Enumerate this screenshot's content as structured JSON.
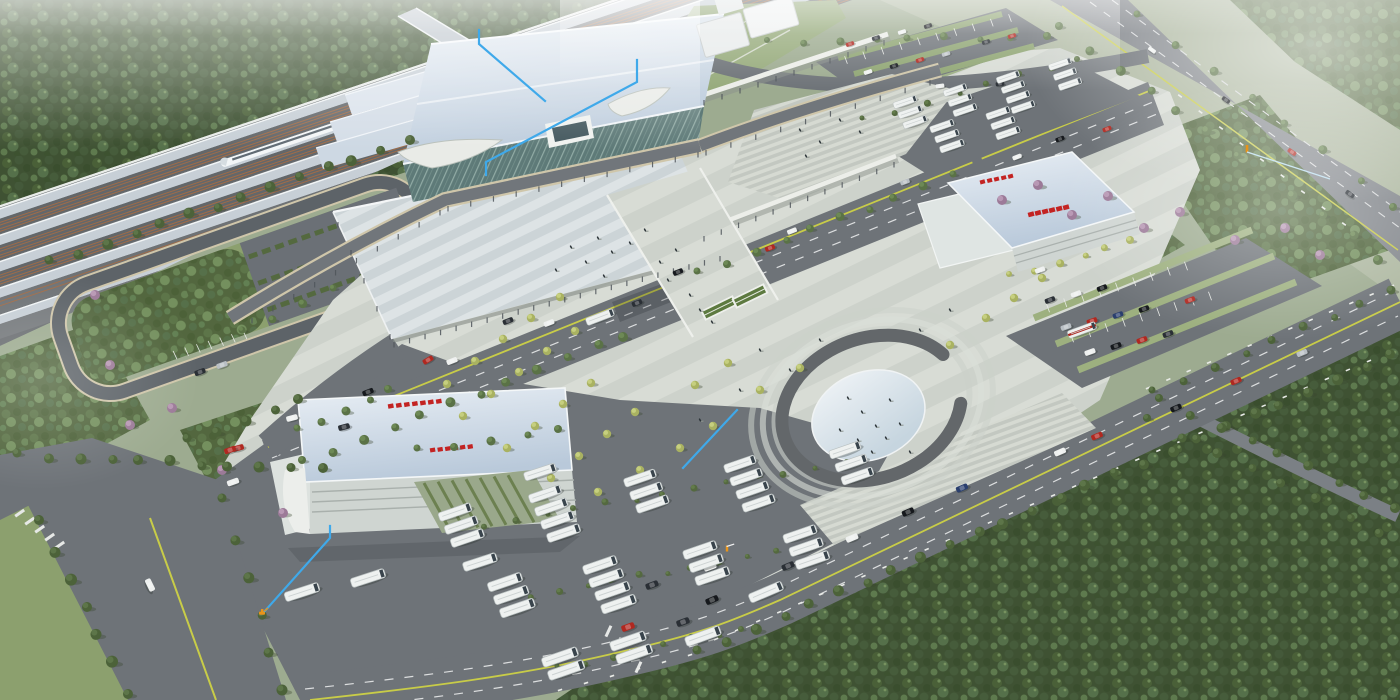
{
  "scene": {
    "type": "aerial-architectural-rendering",
    "subject": "railway-station-complex-masterplan",
    "palette": {
      "base": "#9dab90",
      "fieldLight": "#aeb8a1",
      "forest": "#3f5233",
      "grove": "#53673f",
      "grass": "#8ca06e",
      "lawn": "#97ab7c",
      "road": "#6e7378",
      "roadDark": "#5d6368",
      "hwy": "#83878c",
      "curb": "#cfc6aa",
      "lane": "#dcdedf",
      "yellow": "#c8cc48",
      "plaza": "#d3d7d0",
      "canopy": "#ccd4d7",
      "roof": "#c6d3e2",
      "annex": "#cdd8e3",
      "glass": "#5e7a78",
      "white": "#eef0ef",
      "silver": "#b9bfc4",
      "steel": "#c7cfd6",
      "trackbed": "#6a6e71",
      "ballast": "#a06c48",
      "hedge": "#54693f",
      "treeLight": "#a9b261",
      "treeDark": "#4e6540",
      "blossom": "#9c7a98",
      "red": "#b02820",
      "black": "#16191d",
      "darkcar": "#2a2f35",
      "bluecar": "#2a3f6e",
      "signRed": "#c32322",
      "blue": "#3fa9ea",
      "orange": "#e8941a",
      "oval": "#e6edf2",
      "ovalRing": "#63676a",
      "step": "#ccd1ca"
    },
    "annotation_lines": [
      {
        "points": [
          [
            479,
            30
          ],
          [
            479,
            44
          ],
          [
            545,
            101
          ]
        ]
      },
      {
        "points": [
          [
            486,
            175
          ],
          [
            486,
            162
          ],
          [
            637,
            82
          ],
          [
            637,
            60
          ]
        ]
      },
      {
        "points": [
          [
            737,
            410
          ],
          [
            683,
            468
          ]
        ]
      },
      {
        "points": [
          [
            330,
            526
          ],
          [
            330,
            538
          ],
          [
            264,
            612
          ]
        ]
      }
    ],
    "markers": [
      {
        "kind": "excavator",
        "x": 262,
        "y": 613
      },
      {
        "kind": "gate",
        "x": 727,
        "y": 551
      },
      {
        "kind": "crane",
        "x": 1247,
        "y": 152,
        "line_to": [
          1330,
          179
        ]
      }
    ],
    "vehicles": [
      [
        368,
        392,
        -21,
        "black"
      ],
      [
        452,
        361,
        -21,
        "white"
      ],
      [
        508,
        321,
        -21,
        "darkcar"
      ],
      [
        549,
        323,
        -21,
        "white"
      ],
      [
        637,
        303,
        -21,
        "darkcar"
      ],
      [
        678,
        272,
        -21,
        "black"
      ],
      [
        770,
        248,
        -21,
        "red"
      ],
      [
        792,
        231,
        -21,
        "white"
      ],
      [
        905,
        182,
        -21,
        "silver"
      ],
      [
        1017,
        157,
        -21,
        "white"
      ],
      [
        1060,
        139,
        -21,
        "black"
      ],
      [
        1107,
        129,
        -21,
        "red"
      ],
      [
        600,
        317,
        -21,
        "white",
        "bus"
      ],
      [
        428,
        360,
        -30,
        "red"
      ],
      [
        238,
        448,
        -15,
        "red"
      ],
      [
        292,
        418,
        -15,
        "white"
      ],
      [
        344,
        427,
        -15,
        "darkcar"
      ],
      [
        712,
        600,
        -23,
        "black"
      ],
      [
        788,
        566,
        -23,
        "darkcar"
      ],
      [
        852,
        538,
        -23,
        "white"
      ],
      [
        908,
        512,
        -23,
        "black"
      ],
      [
        962,
        488,
        -23,
        "bluecar"
      ],
      [
        1060,
        452,
        -23,
        "white"
      ],
      [
        1097,
        436,
        -23,
        "red"
      ],
      [
        1176,
        408,
        -23,
        "black"
      ],
      [
        1236,
        381,
        -23,
        "red"
      ],
      [
        1302,
        353,
        -23,
        "silver"
      ],
      [
        766,
        592,
        -23,
        "white",
        "bus"
      ],
      [
        628,
        627,
        -20,
        "red"
      ],
      [
        683,
        622,
        -20,
        "darkcar"
      ],
      [
        703,
        636,
        -20,
        "white",
        "bus"
      ],
      [
        1152,
        50,
        35,
        "white"
      ],
      [
        1226,
        100,
        35,
        "black"
      ],
      [
        1292,
        152,
        35,
        "red"
      ],
      [
        1350,
        194,
        35,
        "darkcar"
      ],
      [
        150,
        585,
        64,
        "white"
      ],
      [
        710,
        567,
        -20,
        "white"
      ],
      [
        652,
        585,
        -20,
        "darkcar"
      ],
      [
        850,
        44,
        -18,
        "red"
      ],
      [
        876,
        38,
        -18,
        "darkcar"
      ],
      [
        902,
        32,
        -18,
        "white"
      ],
      [
        928,
        26,
        -18,
        "black"
      ],
      [
        868,
        72,
        -18,
        "white"
      ],
      [
        894,
        66,
        -18,
        "black"
      ],
      [
        920,
        60,
        -18,
        "red"
      ],
      [
        946,
        54,
        -18,
        "silver"
      ],
      [
        986,
        42,
        -18,
        "darkcar"
      ],
      [
        1012,
        36,
        -18,
        "red"
      ],
      [
        1050,
        300,
        -20,
        "darkcar"
      ],
      [
        1076,
        294,
        -20,
        "white"
      ],
      [
        1102,
        288,
        -20,
        "black"
      ],
      [
        1066,
        327,
        -20,
        "silver"
      ],
      [
        1092,
        321,
        -20,
        "red"
      ],
      [
        1118,
        315,
        -20,
        "bluecar"
      ],
      [
        1144,
        309,
        -20,
        "black"
      ],
      [
        1090,
        352,
        -20,
        "white"
      ],
      [
        1116,
        346,
        -20,
        "black"
      ],
      [
        1142,
        340,
        -20,
        "red"
      ],
      [
        1168,
        334,
        -20,
        "darkcar"
      ],
      [
        1040,
        270,
        -20,
        "white"
      ],
      [
        1190,
        300,
        -20,
        "red"
      ],
      [
        200,
        372,
        -20,
        "darkcar"
      ],
      [
        222,
        365,
        -20,
        "silver"
      ],
      [
        230,
        450,
        -20,
        "red"
      ],
      [
        233,
        482,
        -20,
        "white"
      ],
      [
        940,
        86,
        -8,
        "white"
      ],
      [
        1000,
        84,
        -5,
        "darkcar"
      ]
    ],
    "bus_clusters": [
      [
        455,
        512,
        3
      ],
      [
        545,
        494,
        4
      ],
      [
        640,
        478,
        3
      ],
      [
        740,
        464,
        4
      ],
      [
        845,
        450,
        3
      ],
      [
        505,
        582,
        3
      ],
      [
        600,
        565,
        4
      ],
      [
        700,
        550,
        3
      ],
      [
        800,
        534,
        3
      ],
      [
        628,
        641,
        2
      ],
      [
        560,
        657,
        2
      ]
    ],
    "north_bus_clusters": [
      [
        905,
        102,
        3
      ],
      [
        955,
        90,
        3
      ],
      [
        1008,
        77,
        4
      ],
      [
        1060,
        64,
        3
      ],
      [
        942,
        126,
        3
      ],
      [
        998,
        113,
        3
      ]
    ],
    "single_buses": [
      [
        302,
        592,
        -18
      ],
      [
        368,
        578,
        -18
      ],
      [
        480,
        562,
        -18
      ],
      [
        540,
        472,
        -18
      ],
      [
        1082,
        330,
        -20,
        "red"
      ]
    ],
    "plaza_trees": [
      [
        447,
        384
      ],
      [
        475,
        361
      ],
      [
        503,
        339
      ],
      [
        531,
        318
      ],
      [
        560,
        297
      ],
      [
        463,
        416
      ],
      [
        491,
        394
      ],
      [
        519,
        372
      ],
      [
        547,
        351
      ],
      [
        575,
        331
      ],
      [
        507,
        448
      ],
      [
        535,
        426
      ],
      [
        563,
        404
      ],
      [
        591,
        383
      ],
      [
        551,
        478
      ],
      [
        579,
        456
      ],
      [
        607,
        434
      ],
      [
        635,
        412
      ],
      [
        598,
        492
      ],
      [
        640,
        470
      ],
      [
        680,
        448
      ],
      [
        713,
        426
      ],
      [
        760,
        390
      ],
      [
        800,
        368
      ],
      [
        695,
        385
      ],
      [
        728,
        363
      ],
      [
        986,
        318
      ],
      [
        1014,
        298
      ],
      [
        1042,
        278
      ],
      [
        950,
        345
      ]
    ],
    "blossom_trees": [
      [
        110,
        365
      ],
      [
        130,
        425
      ],
      [
        172,
        408
      ],
      [
        283,
        513
      ],
      [
        222,
        470
      ],
      [
        95,
        295
      ],
      [
        1002,
        200
      ],
      [
        1038,
        185
      ],
      [
        1072,
        215
      ],
      [
        1108,
        196
      ],
      [
        1144,
        228
      ],
      [
        1180,
        212
      ],
      [
        1235,
        240
      ],
      [
        1285,
        228
      ],
      [
        1320,
        255
      ]
    ],
    "tree_lines": [
      {
        "a": [
          700,
          652
        ],
        "b": [
          1392,
          356
        ],
        "n": 26,
        "r": 5,
        "c": "f"
      },
      {
        "a": [
          1155,
          392
        ],
        "b": [
          1392,
          290
        ],
        "n": 9,
        "r": 4,
        "c": "f"
      },
      {
        "a": [
          1062,
          28
        ],
        "b": [
          1380,
          258
        ],
        "n": 12,
        "r": 4.5,
        "c": "g"
      },
      {
        "a": [
          1140,
          16
        ],
        "b": [
          1396,
          206
        ],
        "n": 8,
        "r": 4,
        "c": "g"
      },
      {
        "a": [
          1162,
          400
        ],
        "b": [
          1396,
          508
        ],
        "n": 9,
        "r": 4.5,
        "c": "f"
      },
      {
        "a": [
          1150,
          420
        ],
        "b": [
          1382,
          532
        ],
        "n": 8,
        "r": 4.5,
        "c": "f"
      },
      {
        "a": [
          300,
          430
        ],
        "b": [
          390,
          390
        ],
        "n": 5,
        "r": 4,
        "c": "g"
      },
      {
        "a": [
          305,
          462
        ],
        "b": [
          625,
          335
        ],
        "n": 12,
        "r": 4.5,
        "c": "g"
      },
      {
        "a": [
          700,
          273
        ],
        "b": [
          952,
          175
        ],
        "n": 10,
        "r": 4,
        "c": "g"
      },
      {
        "a": [
          42,
          522
        ],
        "b": [
          126,
          692
        ],
        "n": 7,
        "r": 5.5,
        "c": "f"
      },
      {
        "a": [
          225,
          500
        ],
        "b": [
          282,
          692
        ],
        "n": 6,
        "r": 5,
        "c": "f"
      },
      {
        "a": [
          52,
          262
        ],
        "b": [
          408,
          140
        ],
        "n": 14,
        "r": 5,
        "c": "f"
      },
      {
        "a": [
          20,
          455
        ],
        "b": [
          320,
          470
        ],
        "n": 11,
        "r": 5,
        "c": "f"
      },
      {
        "a": [
          190,
          440
        ],
        "b": [
          300,
          400
        ],
        "n": 5,
        "r": 5,
        "c": "f"
      },
      {
        "a": [
          455,
          530
        ],
        "b": [
          845,
          462
        ],
        "n": 14,
        "r": 3,
        "c": "h"
      },
      {
        "a": [
          505,
          600
        ],
        "b": [
          800,
          548
        ],
        "n": 12,
        "r": 3,
        "c": "h"
      },
      {
        "a": [
          560,
          668
        ],
        "b": [
          744,
          628
        ],
        "n": 8,
        "r": 3,
        "c": "h"
      },
      {
        "a": [
          865,
          120
        ],
        "b": [
          1080,
          58
        ],
        "n": 8,
        "r": 3,
        "c": "h"
      },
      {
        "a": [
          1012,
          276
        ],
        "b": [
          1130,
          242
        ],
        "n": 6,
        "r": 3.5,
        "c": "l"
      },
      {
        "a": [
          245,
          332
        ],
        "b": [
          330,
          288
        ],
        "n": 4,
        "r": 4,
        "c": "g"
      },
      {
        "a": [
          420,
          450
        ],
        "b": [
          560,
          430
        ],
        "n": 5,
        "r": 4,
        "c": "g"
      },
      {
        "a": [
          770,
          42
        ],
        "b": [
          1048,
          36
        ],
        "n": 9,
        "r": 3.5,
        "c": "g"
      }
    ],
    "curb_dash_lines": [
      {
        "a": [
          695,
          648
        ],
        "b": [
          1390,
          352
        ],
        "n": 34,
        "rot": -23
      },
      {
        "a": [
          1148,
          388
        ],
        "b": [
          1392,
          286
        ],
        "n": 13,
        "rot": -23
      },
      {
        "a": [
          1180,
          96
        ],
        "b": [
          1344,
          224
        ],
        "n": 9,
        "rot": 36
      },
      {
        "a": [
          560,
          690
        ],
        "b": [
          690,
          655
        ],
        "n": 6,
        "rot": -18
      },
      {
        "a": [
          175,
          355
        ],
        "b": [
          245,
          335
        ],
        "n": 7,
        "rot": 65,
        "l": 9,
        "w": 0.8
      },
      {
        "a": [
          846,
          60
        ],
        "b": [
          1010,
          18
        ],
        "n": 10,
        "rot": 70,
        "l": 8,
        "w": 0.8
      },
      {
        "a": [
          1048,
          308
        ],
        "b": [
          1186,
          266
        ],
        "n": 9,
        "rot": 70,
        "l": 9,
        "w": 0.8
      },
      {
        "a": [
          1072,
          338
        ],
        "b": [
          1210,
          296
        ],
        "n": 9,
        "rot": 70,
        "l": 9,
        "w": 0.8
      }
    ],
    "column_ticks": [
      {
        "a": [
          252,
          318
        ],
        "b": [
          440,
          210
        ],
        "n": 10
      },
      {
        "a": [
          448,
          206
        ],
        "b": [
          698,
          152
        ],
        "n": 12
      },
      {
        "a": [
          706,
          150
        ],
        "b": [
          930,
          80
        ],
        "n": 10
      },
      {
        "a": [
          394,
          342
        ],
        "b": [
          720,
          256
        ],
        "n": 22
      },
      {
        "a": [
          704,
          236
        ],
        "b": [
          894,
          162
        ],
        "n": 12
      },
      {
        "a": [
          704,
          100
        ],
        "b": [
          884,
          40
        ],
        "n": 11
      },
      {
        "a": [
          338,
          222
        ],
        "b": [
          390,
          334
        ],
        "n": 5
      }
    ],
    "people": [
      [
        598,
        238
      ],
      [
        612,
        252
      ],
      [
        630,
        243
      ],
      [
        586,
        262
      ],
      [
        645,
        230
      ],
      [
        660,
        262
      ],
      [
        676,
        250
      ],
      [
        604,
        276
      ],
      [
        571,
        247
      ],
      [
        556,
        270
      ],
      [
        668,
        280
      ],
      [
        690,
        295
      ],
      [
        700,
        310
      ],
      [
        712,
        322
      ],
      [
        848,
        398
      ],
      [
        862,
        412
      ],
      [
        876,
        426
      ],
      [
        890,
        400
      ],
      [
        858,
        440
      ],
      [
        872,
        452
      ],
      [
        886,
        438
      ],
      [
        900,
        424
      ],
      [
        910,
        452
      ],
      [
        840,
        430
      ],
      [
        760,
        350
      ],
      [
        790,
        370
      ],
      [
        820,
        340
      ],
      [
        740,
        390
      ],
      [
        700,
        420
      ],
      [
        920,
        330
      ],
      [
        950,
        310
      ],
      [
        800,
        130
      ],
      [
        820,
        142
      ],
      [
        840,
        120
      ],
      [
        860,
        132
      ],
      [
        806,
        156
      ]
    ]
  }
}
